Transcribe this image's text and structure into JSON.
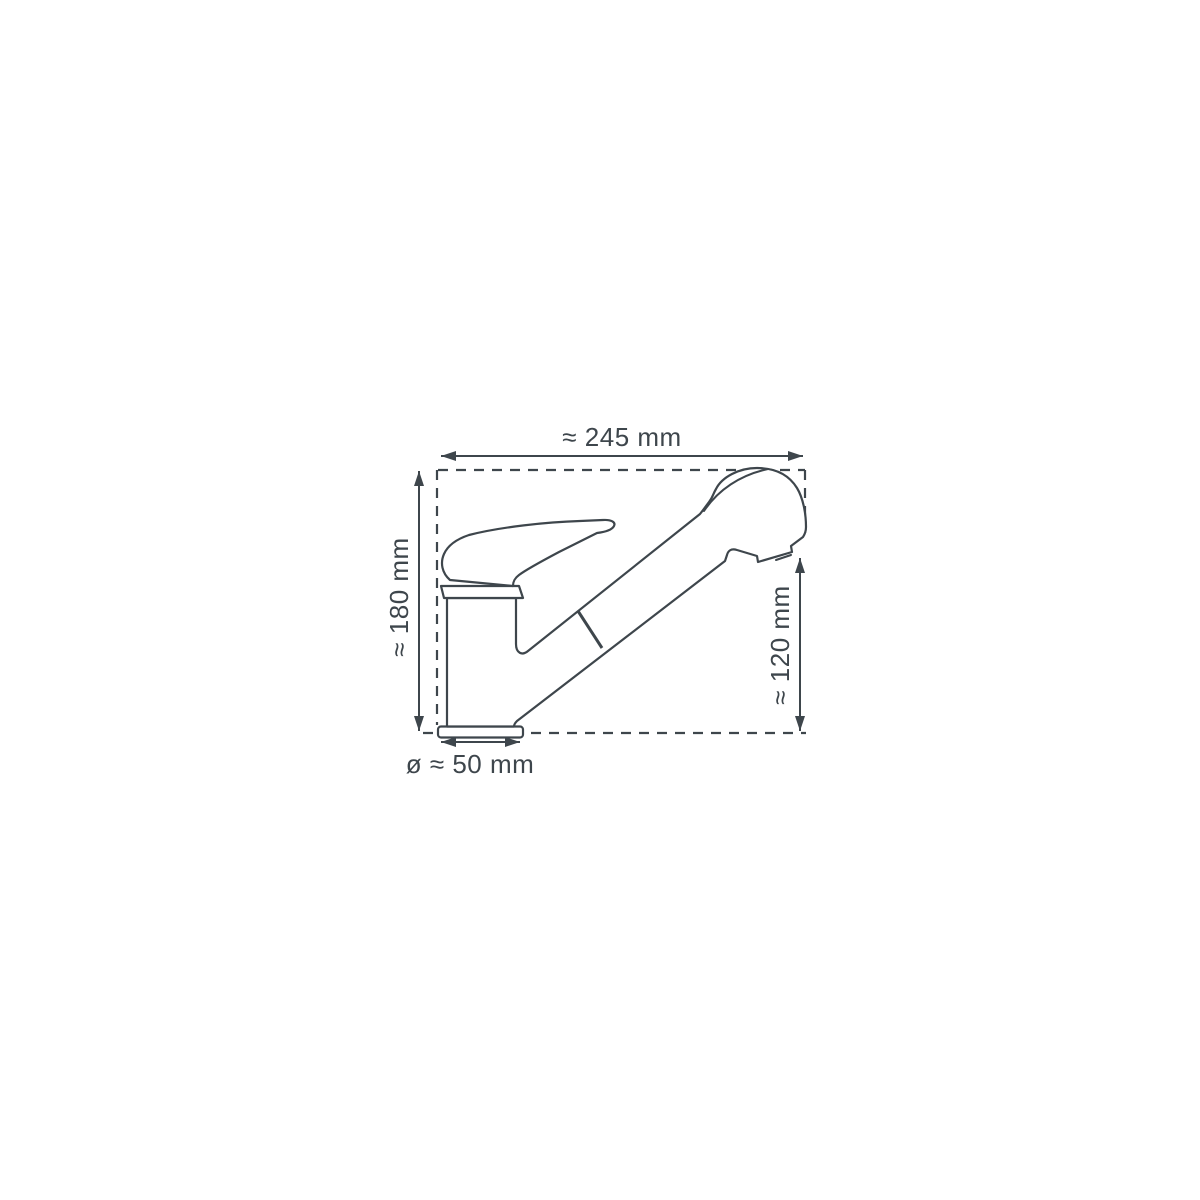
{
  "canvas": {
    "background": "#ffffff",
    "line_color": "#3e464c"
  },
  "labels": {
    "width": "≈ 245 mm",
    "height": "≈ 180 mm",
    "spout_height": "≈ 120 mm",
    "base_diameter": "ø ≈ 50 mm"
  }
}
